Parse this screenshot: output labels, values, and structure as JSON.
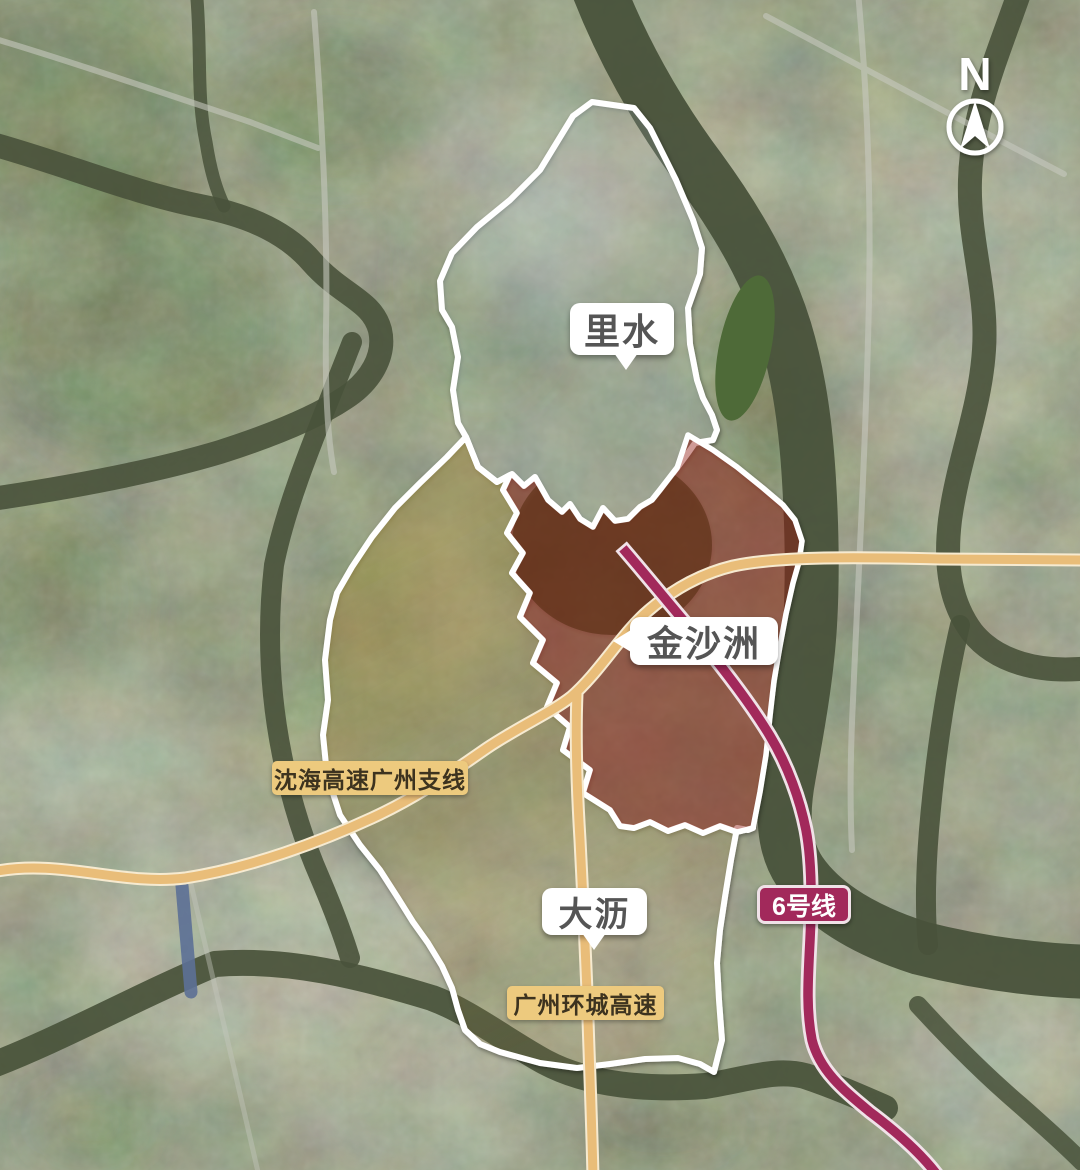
{
  "meta": {
    "description": "satellite map with annotated district boundaries, expressways and a metro line"
  },
  "compass": {
    "label": "N"
  },
  "regions": [
    {
      "id": "lishui",
      "name": "里水"
    },
    {
      "id": "jinshazhou",
      "name": "金沙洲"
    },
    {
      "id": "dali",
      "name": "大沥"
    }
  ],
  "roads": [
    {
      "id": "shenhai-expressway",
      "name": "沈海高速广州支线"
    },
    {
      "id": "ring-expressway",
      "name": "广州环城高速"
    }
  ],
  "metro_lines": [
    {
      "id": "line-6",
      "name": "6号线"
    }
  ],
  "colors": {
    "boundary": "#ffffff",
    "expressway": "#e9bd79",
    "expressway-casing": "#f6ead0",
    "metro": "#a2295b",
    "metro-casing": "#f0e2e8",
    "river": "#49523b",
    "canal-blue": "#5c7096",
    "jinshazhou-tint": "rgba(148,30,22,0.45)",
    "dali-tint": "rgba(176,150,62,0.42)",
    "dali-tint-fade": "rgba(165,140,70,0.10)",
    "lishui-tint": "rgba(200,212,224,0.12)",
    "bubble-bg": "#ffffff",
    "bubble-text": "#555555",
    "road-label-bg": "#edca7e",
    "road-label-text": "#3d331f",
    "metro-label-bg": "#a2295b",
    "metro-label-text": "#ffffff"
  }
}
